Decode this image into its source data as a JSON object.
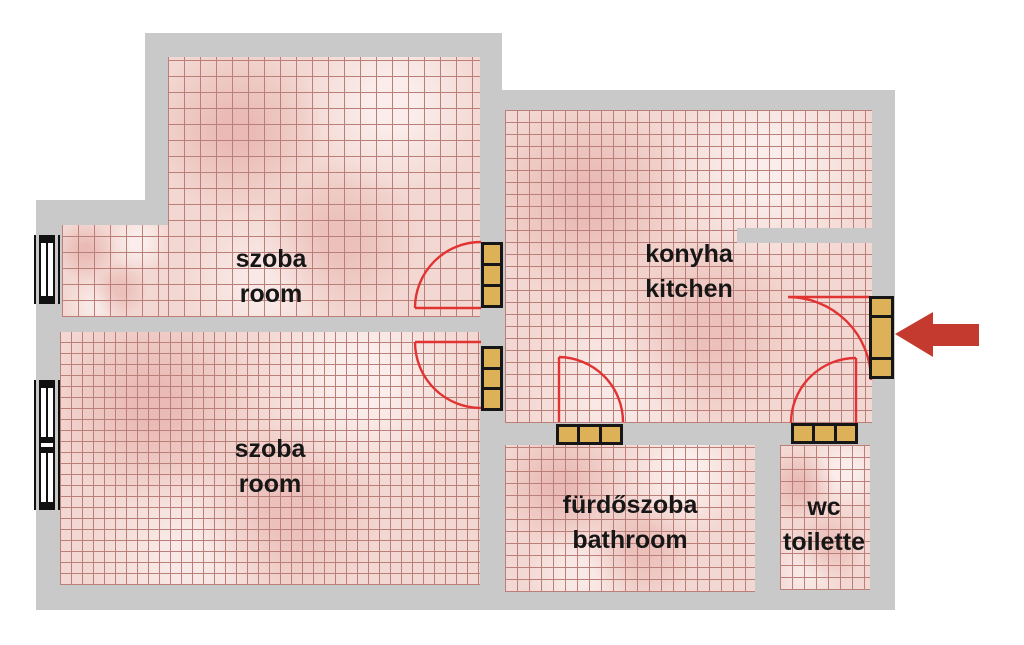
{
  "title": "apartment floor plan",
  "palette": {
    "wall": "#c9c9c9",
    "tile_base": "#f3d7d2",
    "tile_line": "#bb7f79",
    "door_wood": "#ddb157",
    "door_frame": "#161616",
    "swing_red": "#e23333",
    "arrow_red": "#c43a2e",
    "text": "#161616",
    "background": "#ffffff"
  },
  "rooms": [
    {
      "id": "room-upper-left",
      "label_hu": "szoba",
      "label_en": "room"
    },
    {
      "id": "room-lower-left",
      "label_hu": "szoba",
      "label_en": "room"
    },
    {
      "id": "kitchen",
      "label_hu": "konyha",
      "label_en": "kitchen"
    },
    {
      "id": "bathroom",
      "label_hu": "fürdőszoba",
      "label_en": "bathroom"
    },
    {
      "id": "wc",
      "label_hu": "wc",
      "label_en": "toilette"
    }
  ],
  "features": {
    "doors": [
      "upper-room-door",
      "lower-room-door",
      "bathroom-door",
      "wc-door",
      "entrance-door"
    ],
    "windows": [
      "upper-left-window",
      "lower-left-window"
    ],
    "entrance_arrow": "red-arrow-left-pointing-at-entrance-door"
  }
}
